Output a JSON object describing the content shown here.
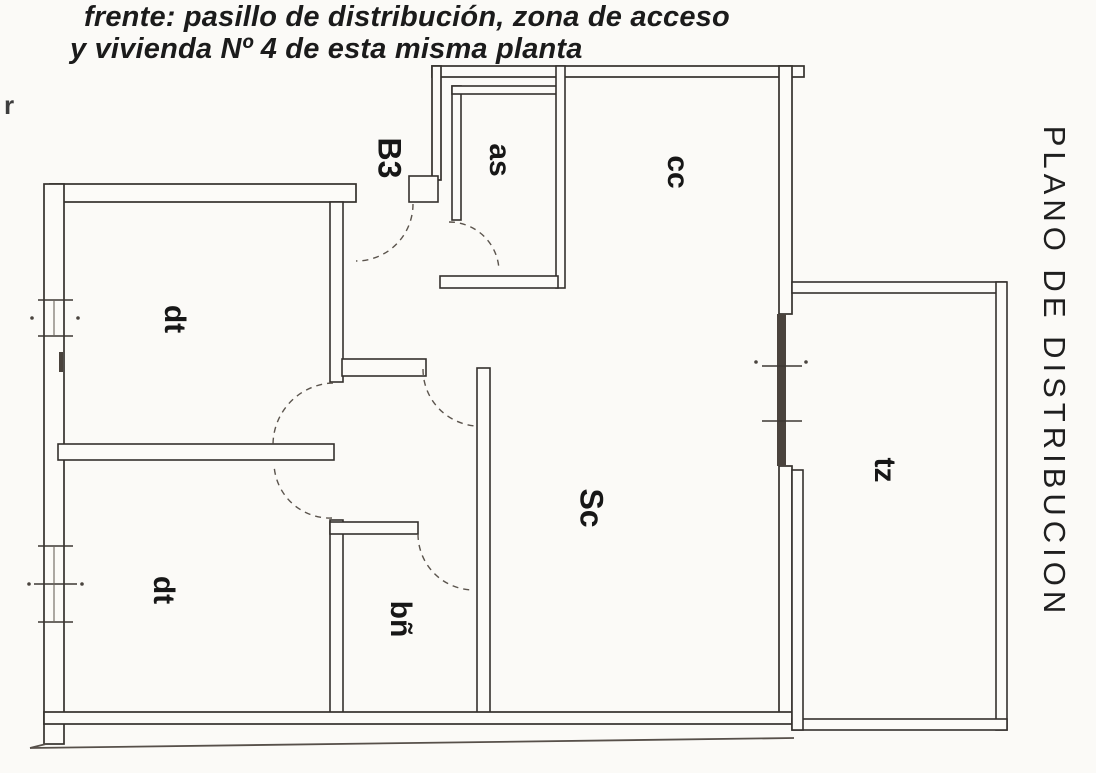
{
  "header": {
    "line1": "frente: pasillo de distribución, zona de acceso",
    "line2": "y vivienda Nº 4 de esta misma planta"
  },
  "side_title": "PLANO DE DISTRIBUCION",
  "plan": {
    "rooms": [
      {
        "id": "b3",
        "label": "B3"
      },
      {
        "id": "as",
        "label": "as"
      },
      {
        "id": "cc",
        "label": "cc"
      },
      {
        "id": "dt-upper",
        "label": "dt"
      },
      {
        "id": "dt-lower",
        "label": "dt"
      },
      {
        "id": "sc",
        "label": "Sc"
      },
      {
        "id": "bn",
        "label": "bñ"
      },
      {
        "id": "tz",
        "label": "tz"
      }
    ]
  },
  "artifacts": {
    "corner_mark": "r"
  },
  "colors": {
    "paper": "#fbfaf7",
    "ink": "#1b1b1b",
    "wall_stroke": "#35312d",
    "glass_fill": "#4a433d"
  }
}
